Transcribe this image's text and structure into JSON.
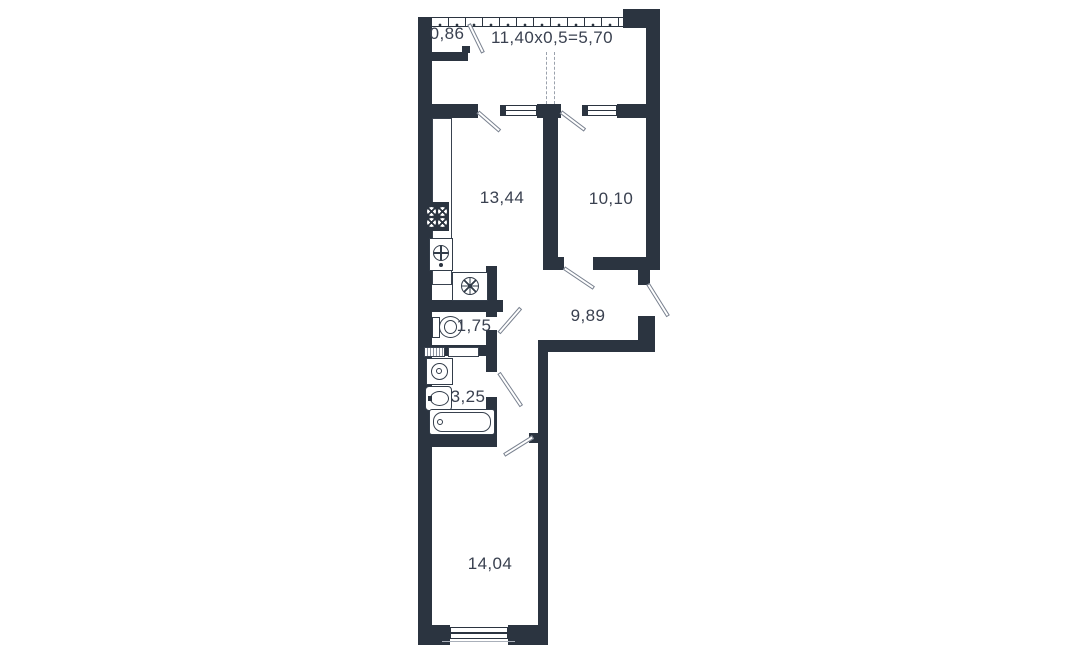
{
  "plan": {
    "type": "apartment-floor-plan",
    "wall_color": "#2b3440",
    "text_color": "#3a4150",
    "background_color": "#ffffff",
    "labels": {
      "closet": "0,86",
      "balcony_formula": "11,40x0,5=5,70",
      "kitchen": "13,44",
      "bedroom": "10,10",
      "hallway": "9,89",
      "wc": "1,75",
      "bathroom": "3,25",
      "living_room": "14,04"
    },
    "fixtures": [
      "stove-icon",
      "kitchen-sink-icon",
      "fridge-icon",
      "kitchen-counter",
      "toilet-icon",
      "towel-dryer-icon",
      "washing-machine-icon",
      "washbasin-icon",
      "bathtub-icon"
    ],
    "openings": [
      "balcony-glazing",
      "balcony-window",
      "balcony-door",
      "closet-door",
      "room-door",
      "entry-door",
      "wc-door",
      "bathroom-door",
      "bedroom-window"
    ]
  }
}
